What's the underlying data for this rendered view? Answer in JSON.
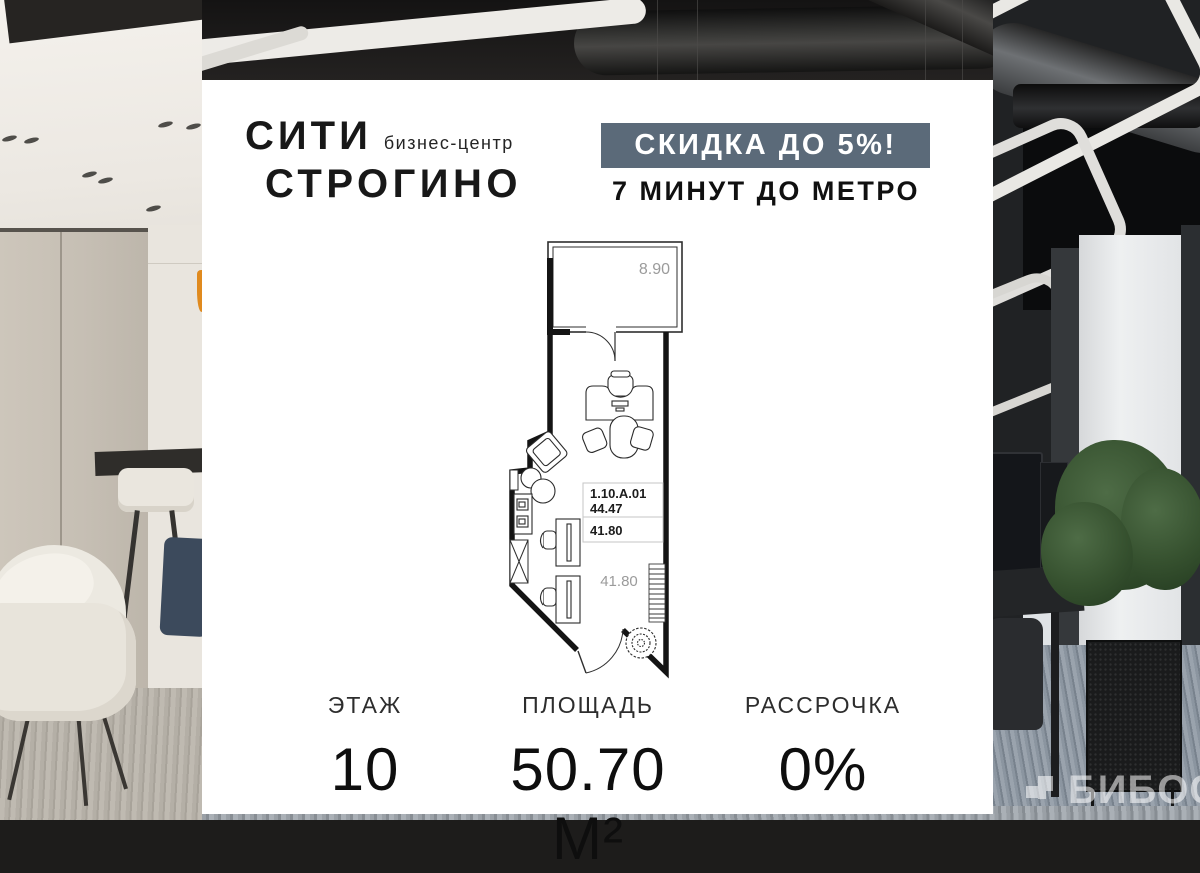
{
  "card": {
    "logo": {
      "line1": "СИТИ",
      "tagline": "бизнес-центр",
      "line2": "СТРОГИНО"
    },
    "promo": {
      "banner": "СКИДКА ДО 5%!",
      "subtitle": "7 МИНУТ ДО МЕТРО"
    },
    "plan": {
      "balcony_area": "8.90",
      "unit_number": "1.10.A.01",
      "unit_total_area": "44.47",
      "unit_room_area": "41.80",
      "room_area_floor": "41.80"
    },
    "stats": [
      {
        "label": "ЭТАЖ",
        "value": "10"
      },
      {
        "label": "ПЛОЩАДЬ",
        "value": "50.70 М²"
      },
      {
        "label": "РАССРОЧКА",
        "value": "0%"
      }
    ],
    "colors": {
      "banner_bg": "#5b6a79",
      "card_bg": "#ffffff",
      "plan_dim_text": "#9b9b9b",
      "wall": "#141414"
    }
  },
  "watermark": {
    "text": "БИБОСС"
  }
}
